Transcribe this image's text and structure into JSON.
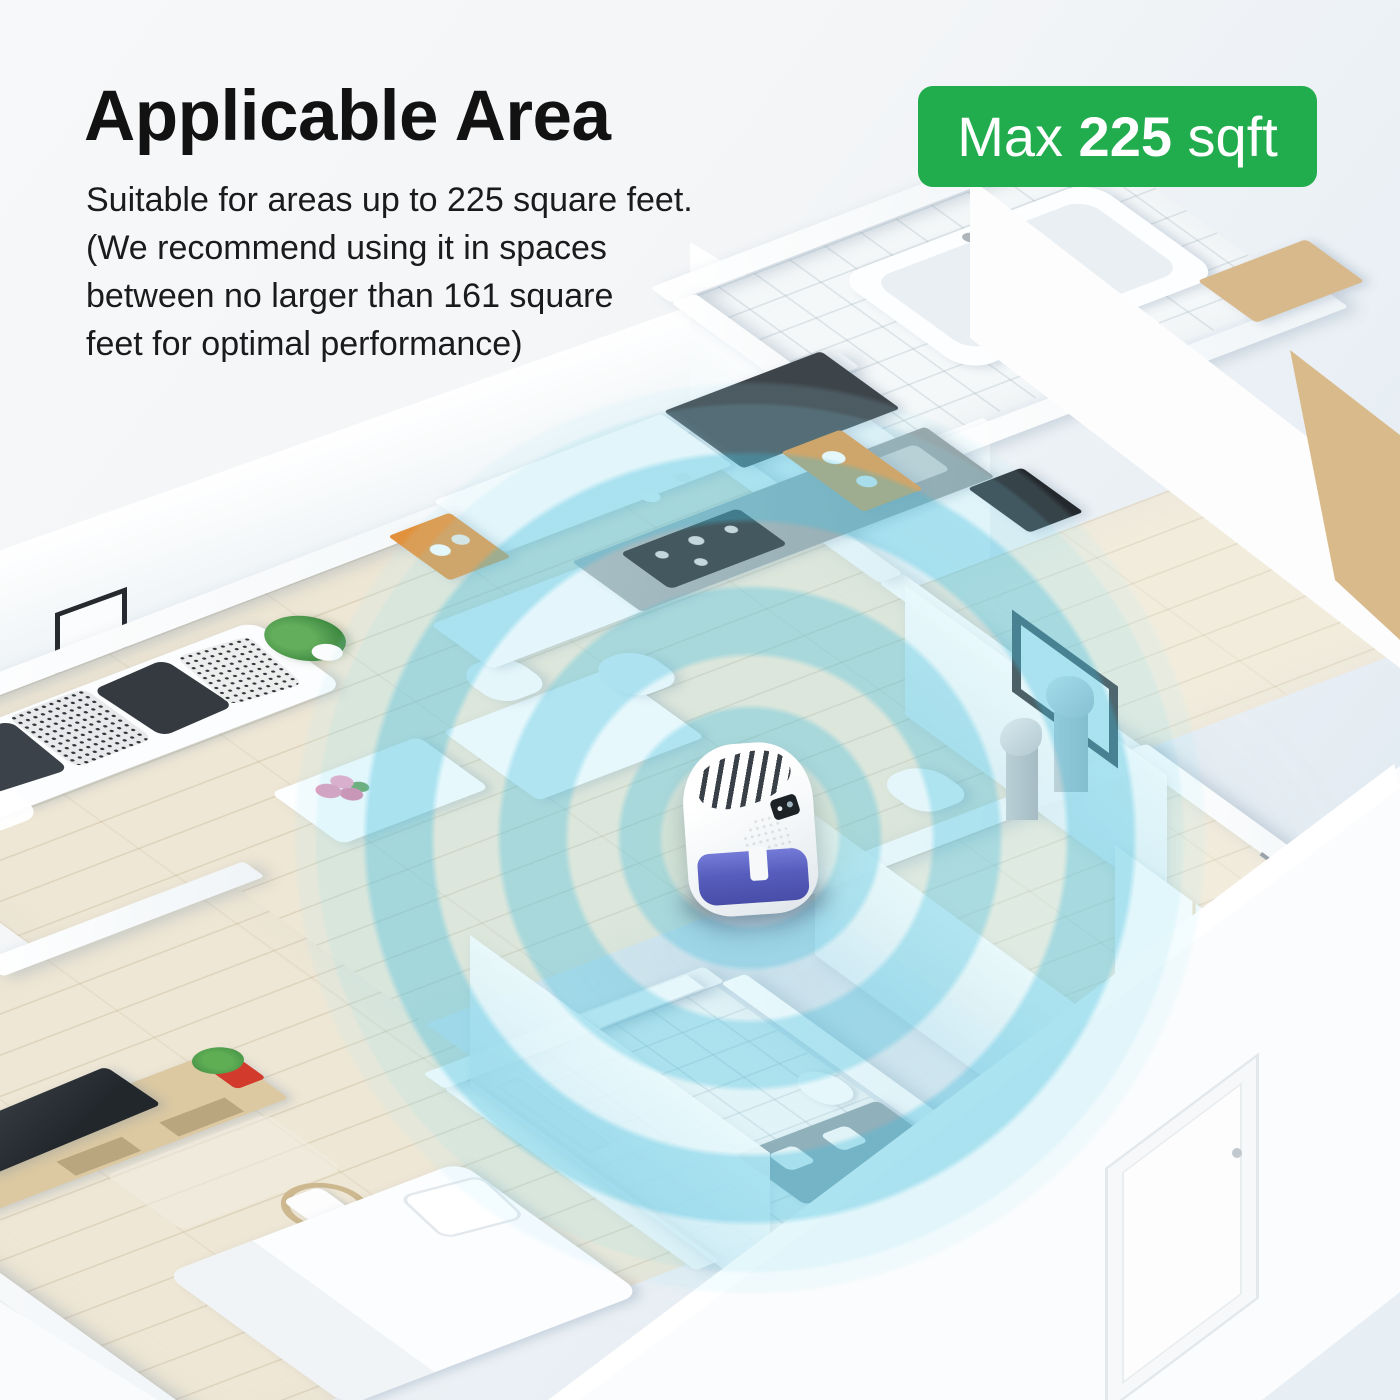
{
  "header": {
    "title": "Applicable Area",
    "description": "Suitable for areas up to 225 square feet.\n(We recommend using it in spaces\nbetween no larger than 161 square\nfeet for optimal performance)"
  },
  "badge": {
    "prefix": "Max ",
    "value": "225",
    "suffix": " sqft"
  },
  "palette": {
    "badge_green": "#21ac4d",
    "ripple_cyan": "#5fc8e2",
    "device_tank_blue": "#4e55b9",
    "kitchen_shelf_orange": "#e2913c",
    "counter_gray": "#a9b2b5",
    "cabinet_charcoal": "#3d444a",
    "wood_floor": "#efe7d5",
    "text_black": "#121212"
  }
}
